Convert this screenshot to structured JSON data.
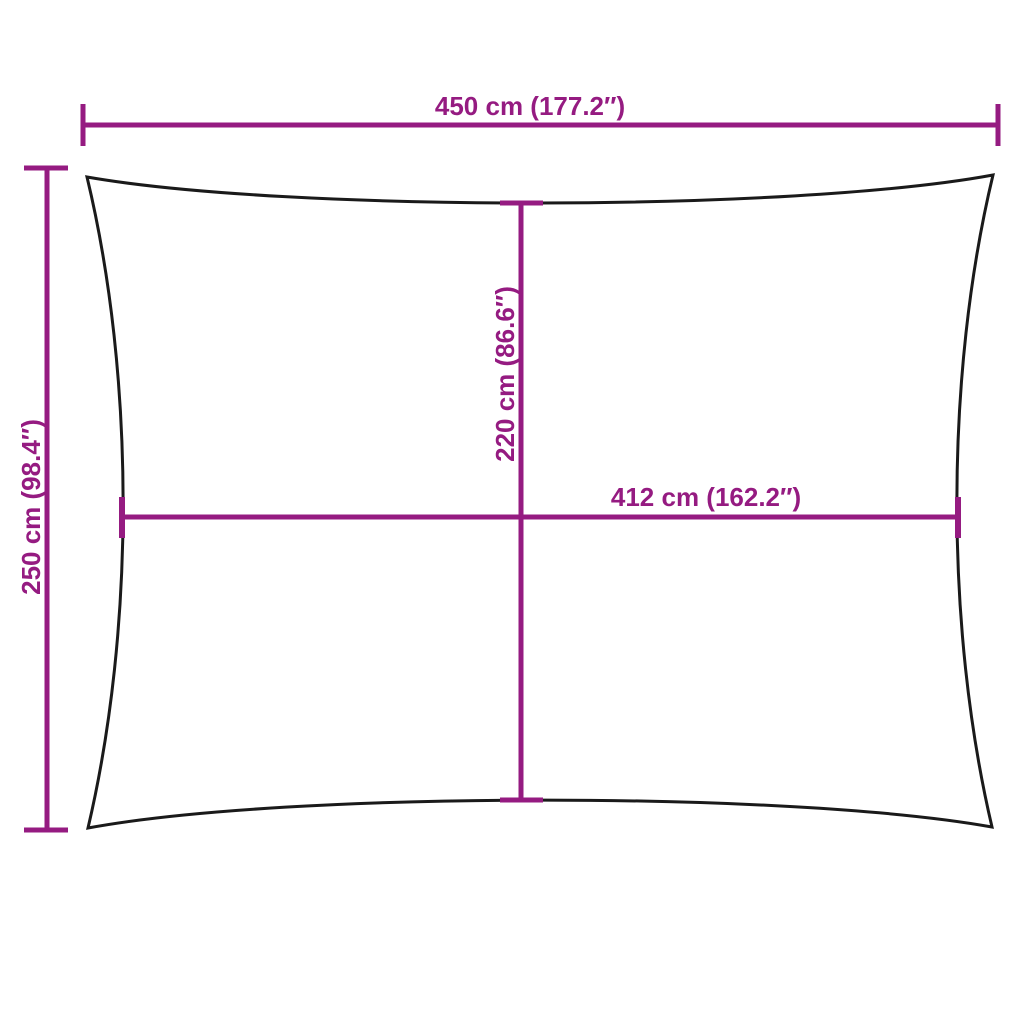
{
  "diagram": {
    "type": "product-dimension-diagram",
    "subject": "rectangular shade sail outline with concave edges",
    "background_color": "#ffffff",
    "outline_color": "#1a1a1a",
    "dimension_color": "#951b81",
    "dimensions": {
      "overall_width": {
        "label": "450 cm (177.2″)",
        "cm": 450,
        "inches": 177.2,
        "orientation": "horizontal",
        "position": "top"
      },
      "overall_height": {
        "label": "250 cm (98.4″)",
        "cm": 250,
        "inches": 98.4,
        "orientation": "vertical",
        "position": "left"
      },
      "inner_height": {
        "label": "220 cm (86.6″)",
        "cm": 220,
        "inches": 86.6,
        "orientation": "vertical",
        "position": "center"
      },
      "inner_width": {
        "label": "412 cm (162.2″)",
        "cm": 412,
        "inches": 162.2,
        "orientation": "horizontal",
        "position": "middle"
      }
    }
  }
}
